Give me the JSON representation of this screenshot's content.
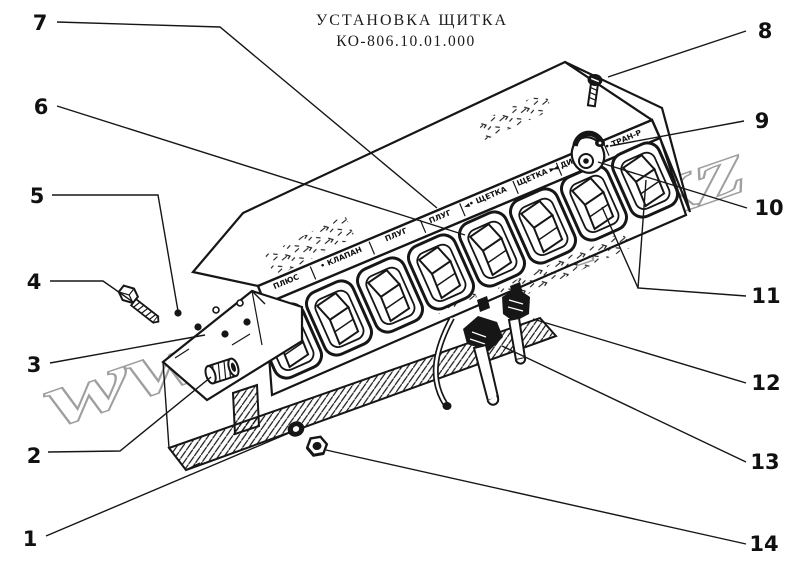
{
  "title": {
    "line1": "УСТАНОВКА ЩИТКА",
    "line2": "КО-806.10.01.000"
  },
  "watermark": "www.sinref.kz",
  "panel_labels": [
    "ПЛЮС",
    "• КЛАПАН",
    "ПЛУГ",
    "ПЛУГ",
    "◄• ЩЕТКА",
    "ЩЕТКА ►",
    "◄ ДИСК",
    "• ТРАН-Р"
  ],
  "callouts": {
    "c1": "1",
    "c2": "2",
    "c3": "3",
    "c4": "4",
    "c5": "5",
    "c6": "6",
    "c7": "7",
    "c8": "8",
    "c9": "9",
    "c10": "10",
    "c11": "11",
    "c12": "12",
    "c13": "13",
    "c14": "14"
  }
}
